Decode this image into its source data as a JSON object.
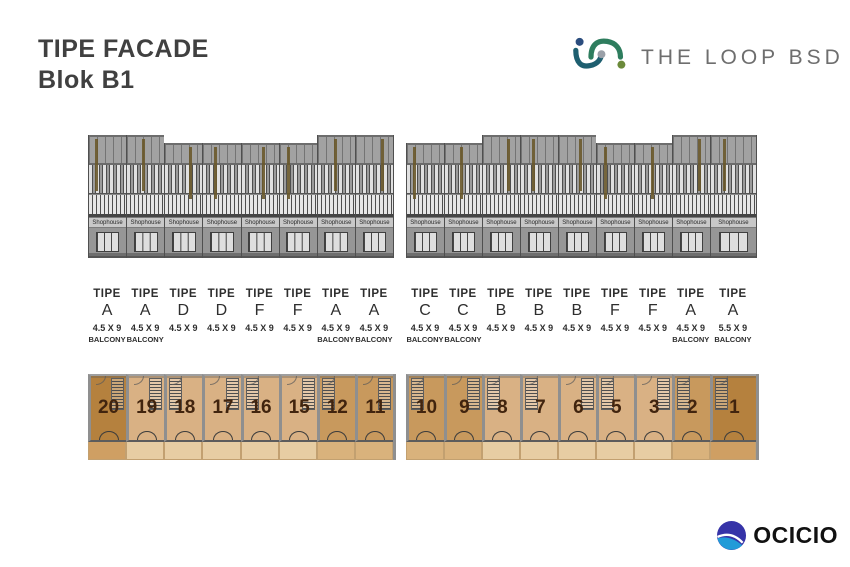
{
  "title": {
    "line1": "TIPE FACADE",
    "line2": "Blok B1"
  },
  "brand_top": {
    "name": "THE LOOP BSD"
  },
  "brand_bottom": {
    "name": "OCICIO"
  },
  "labels": {
    "tipe_word": "TIPE",
    "balcony_word": "BALCONY"
  },
  "facade": {
    "sign_text": "Shophouse"
  },
  "buildings": [
    {
      "id": "left",
      "units": [
        {
          "tipe": "A",
          "size": "4.5 X 9",
          "balcony": true,
          "plan_no": "20",
          "tall": true,
          "wide": false,
          "shade": "dark",
          "stair": "right"
        },
        {
          "tipe": "A",
          "size": "4.5 X 9",
          "balcony": true,
          "plan_no": "19",
          "tall": true,
          "wide": false,
          "shade": "light",
          "stair": "right"
        },
        {
          "tipe": "D",
          "size": "4.5 X 9",
          "balcony": false,
          "plan_no": "18",
          "tall": false,
          "wide": false,
          "shade": "light",
          "stair": "left"
        },
        {
          "tipe": "D",
          "size": "4.5 X 9",
          "balcony": false,
          "plan_no": "17",
          "tall": false,
          "wide": false,
          "shade": "light",
          "stair": "right"
        },
        {
          "tipe": "F",
          "size": "4.5 X 9",
          "balcony": false,
          "plan_no": "16",
          "tall": false,
          "wide": false,
          "shade": "light",
          "stair": "left"
        },
        {
          "tipe": "F",
          "size": "4.5 X 9",
          "balcony": false,
          "plan_no": "15",
          "tall": false,
          "wide": false,
          "shade": "light",
          "stair": "right"
        },
        {
          "tipe": "A",
          "size": "4.5 X 9",
          "balcony": true,
          "plan_no": "12",
          "tall": true,
          "wide": false,
          "shade": "medium",
          "stair": "left"
        },
        {
          "tipe": "A",
          "size": "4.5 X 9",
          "balcony": true,
          "plan_no": "11",
          "tall": true,
          "wide": false,
          "shade": "medium",
          "stair": "right"
        }
      ]
    },
    {
      "id": "right",
      "units": [
        {
          "tipe": "C",
          "size": "4.5 X 9",
          "balcony": true,
          "plan_no": "10",
          "tall": false,
          "wide": false,
          "shade": "medium",
          "stair": "left"
        },
        {
          "tipe": "C",
          "size": "4.5 X 9",
          "balcony": true,
          "plan_no": "9",
          "tall": false,
          "wide": false,
          "shade": "medium",
          "stair": "right"
        },
        {
          "tipe": "B",
          "size": "4.5 X 9",
          "balcony": false,
          "plan_no": "8",
          "tall": true,
          "wide": false,
          "shade": "light",
          "stair": "left"
        },
        {
          "tipe": "B",
          "size": "4.5 X 9",
          "balcony": false,
          "plan_no": "7",
          "tall": true,
          "wide": false,
          "shade": "light",
          "stair": "left"
        },
        {
          "tipe": "B",
          "size": "4.5 X 9",
          "balcony": false,
          "plan_no": "6",
          "tall": true,
          "wide": false,
          "shade": "light",
          "stair": "right"
        },
        {
          "tipe": "F",
          "size": "4.5 X 9",
          "balcony": false,
          "plan_no": "5",
          "tall": false,
          "wide": false,
          "shade": "light",
          "stair": "left"
        },
        {
          "tipe": "F",
          "size": "4.5 X 9",
          "balcony": false,
          "plan_no": "3",
          "tall": false,
          "wide": false,
          "shade": "light",
          "stair": "right"
        },
        {
          "tipe": "A",
          "size": "4.5 X 9",
          "balcony": true,
          "plan_no": "2",
          "tall": true,
          "wide": false,
          "shade": "medium",
          "stair": "left"
        },
        {
          "tipe": "A",
          "size": "5.5 X 9",
          "balcony": true,
          "plan_no": "1",
          "tall": true,
          "wide": true,
          "shade": "dark",
          "stair": "left"
        }
      ]
    }
  ],
  "colors": {
    "title_text": "#404040",
    "loop_logo_text": "#6e6e6e",
    "loop_arc_blue": "#2b4d7e",
    "loop_arc_teal": "#2e7d5e",
    "loop_dot_gray": "#9aa0a8",
    "loop_dot_green": "#6b8a3a",
    "facade_wall": "#a2a2a2",
    "facade_accent_olive": "#6a592b",
    "shophouse_sign_band": "#c8c8c8",
    "plan_dark": "#b5813e",
    "plan_medium": "#c8995d",
    "plan_light": "#d9b184",
    "label_text": "#2e2e2e",
    "ocicio_dark_blue": "#3633a8",
    "ocicio_light_blue": "#219bd8",
    "ocicio_text": "#111111"
  }
}
